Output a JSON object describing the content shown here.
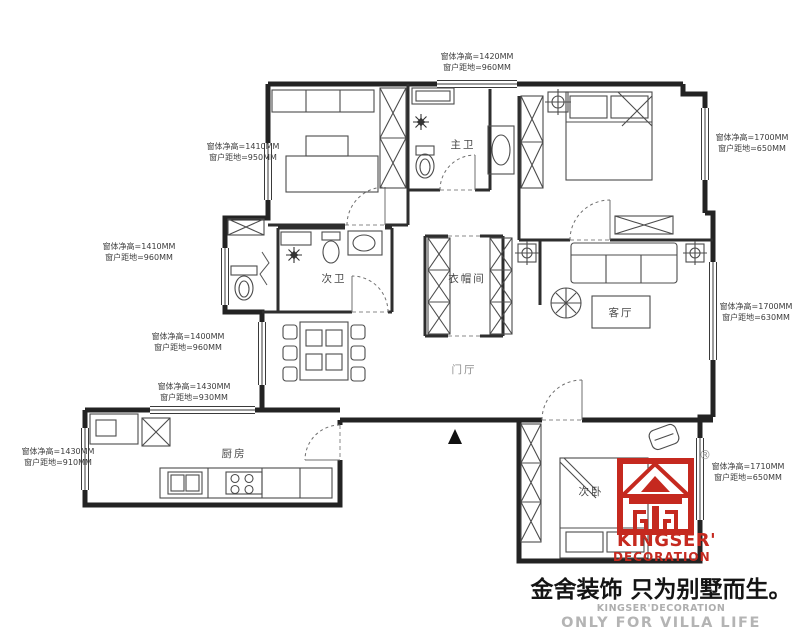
{
  "plan": {
    "window_annotations": [
      {
        "id": "top-center",
        "line1": "窗体净高=1420MM",
        "line2": "窗户距地=960MM"
      },
      {
        "id": "left-top",
        "line1": "窗体净高=1410MM",
        "line2": "窗户距地=950MM"
      },
      {
        "id": "left-middle",
        "line1": "窗体净高=1410MM",
        "line2": "窗户距地=960MM"
      },
      {
        "id": "left-lower",
        "line1": "窗体净高=1400MM",
        "line2": "窗户距地=960MM"
      },
      {
        "id": "left-bottom",
        "line1": "窗体净高=1430MM",
        "line2": "窗户距地=930MM"
      },
      {
        "id": "far-left-bottom",
        "line1": "窗体净高=1430MM",
        "line2": "窗户距地=910MM"
      },
      {
        "id": "right-top",
        "line1": "窗体净高=1700MM",
        "line2": "窗户距地=650MM"
      },
      {
        "id": "right-middle",
        "line1": "窗体净高=1700MM",
        "line2": "窗户距地=630MM"
      },
      {
        "id": "right-bottom",
        "line1": "窗体净高=1710MM",
        "line2": "窗户距地=650MM"
      }
    ],
    "rooms": [
      {
        "id": "master-bath",
        "label": "主卫"
      },
      {
        "id": "second-bath",
        "label": "次卫"
      },
      {
        "id": "cloakroom",
        "label": "衣帽间"
      },
      {
        "id": "living-room",
        "label": "客厅"
      },
      {
        "id": "entry-hall",
        "label": "门厅"
      },
      {
        "id": "kitchen",
        "label": "厨房"
      },
      {
        "id": "second-bedroom",
        "label": "次卧"
      }
    ],
    "icons": {
      "north_arrow": "solid black triangle pointing up",
      "ceiling_light": "circle-cross in square",
      "shower_light": "eight-ray star"
    }
  },
  "branding": {
    "registered_mark": "®",
    "logo_line1": "KINGSER'",
    "logo_line2": "DECORATION",
    "slogan_cn": "金舍装饰 只为别墅而生。",
    "slogan_en1": "KINGSER'DECORATION",
    "slogan_en2": "ONLY FOR VILLA LIFE"
  },
  "colors": {
    "brand_red": "#c5291f",
    "line_dark": "#2b2b2b",
    "text_gray": "#aeaeae"
  }
}
